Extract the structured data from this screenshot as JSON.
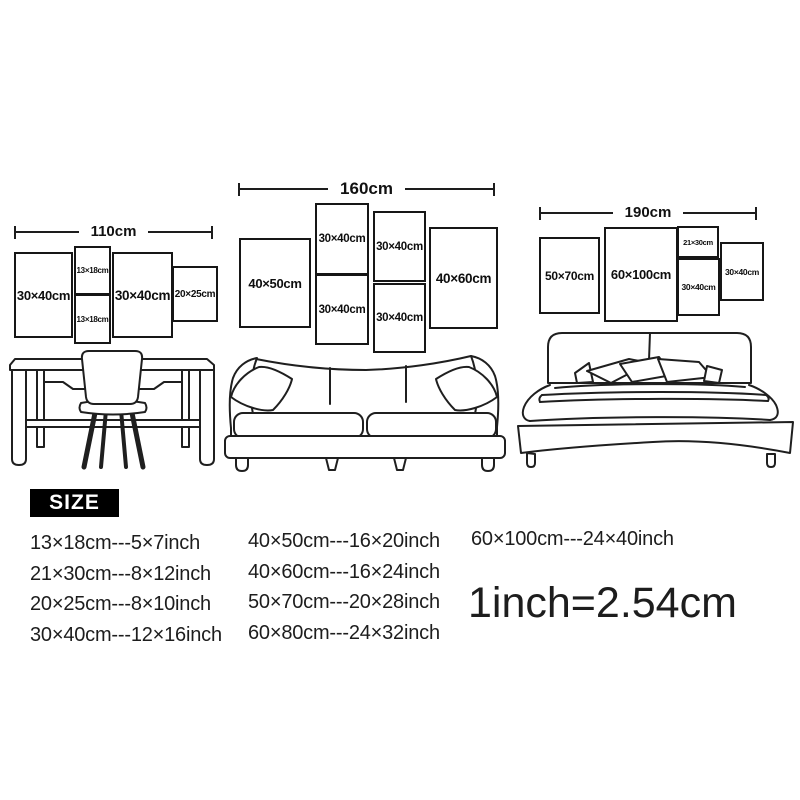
{
  "colors": {
    "ink": "#1d1d1d",
    "background": "#ffffff",
    "size_badge_bg": "#000000",
    "size_badge_text": "#ffffff"
  },
  "groups": [
    {
      "width_label": "110cm",
      "furniture": "desk-with-chair",
      "frames": [
        {
          "label": "30×40cm"
        },
        {
          "label": "13×18cm"
        },
        {
          "label": "13×18cm"
        },
        {
          "label": "30×40cm"
        },
        {
          "label": "20×25cm"
        }
      ]
    },
    {
      "width_label": "160cm",
      "furniture": "sofa",
      "frames": [
        {
          "label": "40×50cm"
        },
        {
          "label": "30×40cm"
        },
        {
          "label": "30×40cm"
        },
        {
          "label": "30×40cm"
        },
        {
          "label": "30×40cm"
        },
        {
          "label": "40×60cm"
        }
      ]
    },
    {
      "width_label": "190cm",
      "furniture": "double-bed",
      "frames": [
        {
          "label": "50×70cm"
        },
        {
          "label": "60×100cm"
        },
        {
          "label": "21×30cm"
        },
        {
          "label": "30×40cm"
        },
        {
          "label": "30×40cm"
        }
      ]
    }
  ],
  "size_table": {
    "heading": "SIZE",
    "columns": [
      [
        "13×18cm---5×7inch",
        "21×30cm---8×12inch",
        "20×25cm---8×10inch",
        "30×40cm---12×16inch"
      ],
      [
        "40×50cm---16×20inch",
        "40×60cm---16×24inch",
        "50×70cm---20×28inch",
        "60×80cm---24×32inch"
      ],
      [
        "60×100cm---24×40inch"
      ]
    ],
    "conversion_note": "1inch=2.54cm"
  }
}
